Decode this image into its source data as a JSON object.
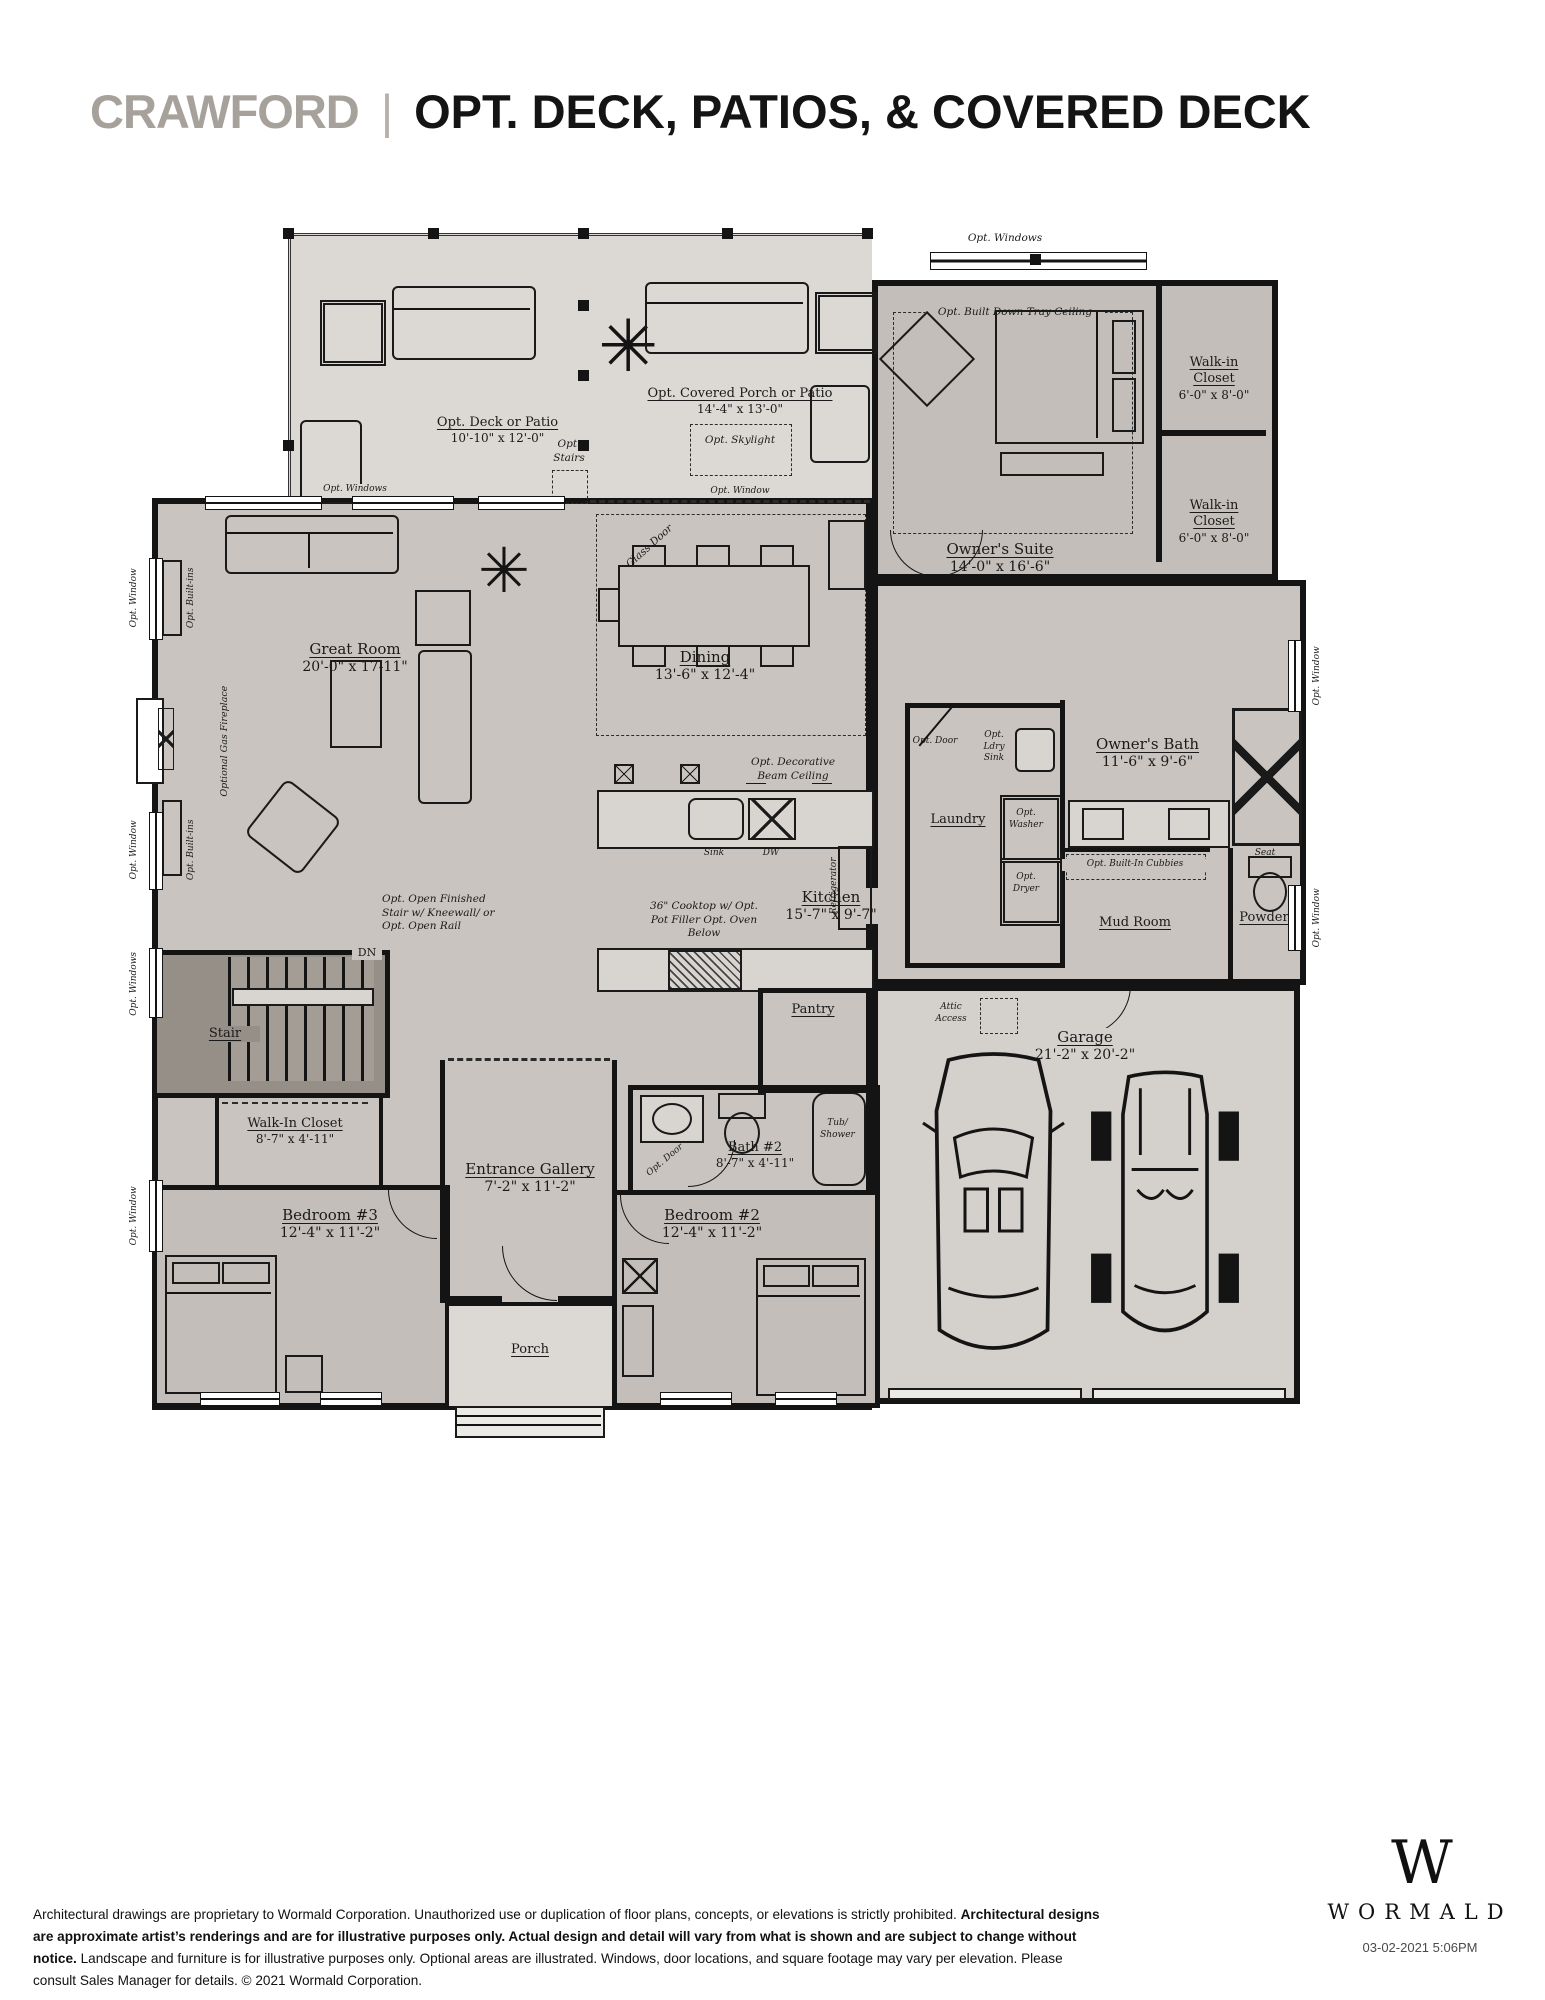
{
  "header": {
    "brand": "CRAWFORD",
    "separator": "|",
    "title": "OPT. DECK, PATIOS, & COVERED DECK"
  },
  "rooms": {
    "deck": {
      "name": "Opt. Deck or Patio",
      "dims": "10'-10\" x 12'-0\""
    },
    "covered_porch": {
      "name": "Opt. Covered Porch or Patio",
      "dims": "14'-4\" x 13'-0\""
    },
    "owners_suite": {
      "name": "Owner's Suite",
      "dims": "14'-0\" x 16'-6\""
    },
    "walkin_closet_a": {
      "name": "Walk-in Closet",
      "dims": "6'-0\" x 8'-0\""
    },
    "walkin_closet_b": {
      "name": "Walk-in Closet",
      "dims": "6'-0\" x 8'-0\""
    },
    "great_room": {
      "name": "Great Room",
      "dims": "20'-0\" x 17-11\""
    },
    "dining": {
      "name": "Dining",
      "dims": "13'-6\" x 12'-4\""
    },
    "owners_bath": {
      "name": "Owner's Bath",
      "dims": "11'-6\" x 9'-6\""
    },
    "laundry": {
      "name": "Laundry"
    },
    "kitchen": {
      "name": "Kitchen",
      "dims": "15'-7\" x 9'-7\""
    },
    "mud_room": {
      "name": "Mud Room"
    },
    "powder": {
      "name": "Powder"
    },
    "pantry": {
      "name": "Pantry"
    },
    "stair": {
      "name": "Stair"
    },
    "walkin_closet_c": {
      "name": "Walk-In Closet",
      "dims": "8'-7\" x 4'-11\""
    },
    "bedroom3": {
      "name": "Bedroom #3",
      "dims": "12'-4\" x 11'-2\""
    },
    "entrance_gallery": {
      "name": "Entrance Gallery",
      "dims": "7'-2\" x 11'-2\""
    },
    "bath2": {
      "name": "Bath #2",
      "dims": "8'-7\" x 4'-11\""
    },
    "bedroom2": {
      "name": "Bedroom #2",
      "dims": "12'-4\" x 11'-2\""
    },
    "porch": {
      "name": "Porch"
    },
    "garage": {
      "name": "Garage",
      "dims": "21'-2\" x 20'-2\""
    }
  },
  "annotations": {
    "opt_windows": "Opt. Windows",
    "opt_window": "Opt. Window",
    "opt_built_ins": "Opt. Built-ins",
    "opt_stairs": "Opt. Stairs",
    "opt_skylight": "Opt. Skylight",
    "opt_tray_ceiling": "Opt. Built Down Tray Ceiling",
    "glass_door": "Glass Door",
    "gas_fireplace": "Optional Gas Fireplace",
    "beam_ceiling": "Opt. Decorative Beam Ceiling",
    "opt_door": "Opt. Door",
    "opt_ldry_sink": "Opt. Ldry Sink",
    "opt_washer": "Opt. Washer",
    "opt_dryer": "Opt. Dryer",
    "seat": "Seat",
    "opt_cubbies": "Opt. Built-In Cubbies",
    "sink": "Sink",
    "dw": "DW",
    "refrigerator": "Refrigerator",
    "cooktop": "36\" Cooktop w/ Opt. Pot Filler Opt. Oven Below",
    "open_stair": "Opt. Open Finished Stair w/ Kneewall/ or Opt. Open Rail",
    "dn": "DN",
    "tub_shower": "Tub/ Shower",
    "attic_access": "Attic Access"
  },
  "footer": {
    "text_1": "Architectural drawings are proprietary to Wormald Corporation. Unauthorized use or duplication of floor plans, concepts, or elevations is strictly prohibited. ",
    "text_bold": "Architectural designs are approximate artist’s renderings and are for illustrative purposes only. Actual design and detail will vary from what is shown and are subject to change without notice.",
    "text_2": " Landscape and furniture is for illustrative purposes only. Optional areas are illustrated. Windows, door locations, and square footage may vary per elevation. Please consult Sales Manager for details. © 2021 Wormald Corporation."
  },
  "logo": {
    "monogram": "W",
    "name": "WORMALD",
    "timestamp": "03-02-2021 5:06PM"
  },
  "colors": {
    "brand_gray": "#a7a19b",
    "ink": "#141414",
    "outdoor_fill": "#dcd9d4",
    "interior_fill": "#c9c4bf",
    "suite_fill": "#c3beb9",
    "stair_fill": "#a39d96",
    "garage_fill": "#d4d1cd"
  }
}
